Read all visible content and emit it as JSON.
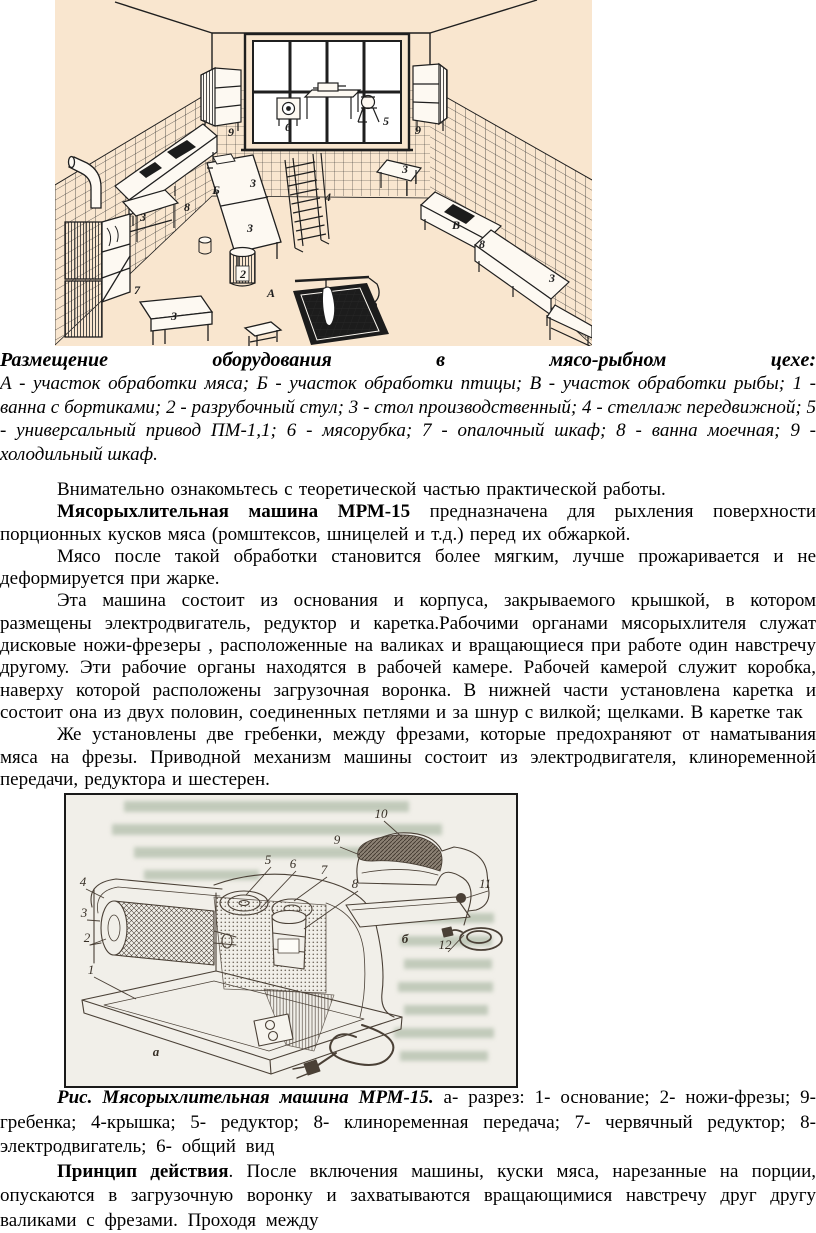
{
  "document": {
    "language": "ru",
    "page_background": "#ffffff",
    "text_color": "#000000"
  },
  "figure_workshop": {
    "background_color": "#f9e6cf",
    "line_color": "#1f1f1f",
    "labels": [
      {
        "t": "9",
        "x": 176,
        "y": 136
      },
      {
        "t": "Б",
        "x": 161,
        "y": 194
      },
      {
        "t": "8",
        "x": 132,
        "y": 211
      },
      {
        "t": "3",
        "x": 88,
        "y": 221
      },
      {
        "t": "7",
        "x": 82,
        "y": 294
      },
      {
        "t": "3",
        "x": 119,
        "y": 320
      },
      {
        "t": "6",
        "x": 233,
        "y": 131
      },
      {
        "t": "5",
        "x": 331,
        "y": 125
      },
      {
        "t": "9",
        "x": 363,
        "y": 134
      },
      {
        "t": "3",
        "x": 198,
        "y": 187
      },
      {
        "t": "3",
        "x": 195,
        "y": 232
      },
      {
        "t": "4",
        "x": 273,
        "y": 201
      },
      {
        "t": "2",
        "x": 188,
        "y": 278
      },
      {
        "t": "А",
        "x": 216,
        "y": 297
      },
      {
        "t": "3",
        "x": 350,
        "y": 173
      },
      {
        "t": "В",
        "x": 401,
        "y": 229
      },
      {
        "t": "8",
        "x": 427,
        "y": 248
      },
      {
        "t": "3",
        "x": 497,
        "y": 282
      }
    ]
  },
  "caption_workshop": {
    "title": "Размещение оборудования в мясо-рыбном цехе:",
    "legend": "А - участок обработки мяса; Б - участок обработки птицы; В - участок обработки рыбы; 1 - ванна с бортиками; 2 - разрубочный стул; 3 - стол производственный; 4 - стеллаж передвижной; 5 - универсальный привод ПМ-1,1; 6 - мясорубка; 7 - опалочный шкаф; 8 - ванна моечная; 9 - холодильный шкаф."
  },
  "body_text": {
    "p1": "Внимательно ознакомьтесь с теоретической частью практической работы.",
    "p2_bold": "Мясорыхлительная машина МРМ-15",
    "p2_rest": " предназначена для рыхления поверхности порционных кусков мяса (ромштексов, шницелей и т.д.) перед их обжаркой.",
    "p3": "Мясо после такой обработки становится более мягким, лучше прожаривается и не деформируется при жарке.",
    "p4": "Эта машина состоит из основания и корпуса, закрываемого крышкой, в котором размещены электродвигатель, редуктор и каретка.Рабочими органами мясорыхлителя служат дисковые ножи-фрезеры , расположенные на валиках и вращающиеся при работе один навстречу другому. Эти рабочие органы находятся в рабочей камере. Рабочей камерой служит коробка, наверху которой расположены загрузочная воронка. В нижней части установлена каретка и состоит она из двух половин, соединенных петлями и за шнур с вилкой; щелками. В каретке так",
    "p5": "Же установлены две гребенки, между фрезами, которые предохраняют от наматывания мяса на фрезы. Приводной механизм машины состоит из электродвигателя, клиноременной передачи, редуктора и шестерен."
  },
  "figure_machine": {
    "background_color": "#f1efe9",
    "line_color": "#4a4036",
    "border_color": "#1a1a1a",
    "letters": [
      {
        "n": "а",
        "x": 92,
        "y": 263
      },
      {
        "n": "б",
        "x": 341,
        "y": 150
      }
    ],
    "callouts": [
      {
        "n": "4",
        "x": 19,
        "y": 93,
        "tx": 40,
        "ty": 105
      },
      {
        "n": "3",
        "x": 20,
        "y": 124,
        "tx": 36,
        "ty": 128
      },
      {
        "n": "2",
        "x": 23,
        "y": 149,
        "tx": 42,
        "ty": 146
      },
      {
        "n": "1",
        "x": 27,
        "y": 181,
        "tx": 72,
        "ty": 206
      },
      {
        "n": "5",
        "x": 204,
        "y": 71,
        "tx": 182,
        "ty": 102
      },
      {
        "n": "6",
        "x": 229,
        "y": 75,
        "tx": 196,
        "ty": 116
      },
      {
        "n": "7",
        "x": 260,
        "y": 81,
        "tx": 230,
        "ty": 108
      },
      {
        "n": "8",
        "x": 291,
        "y": 95,
        "tx": 240,
        "ty": 136
      },
      {
        "n": "9",
        "x": 273,
        "y": 51,
        "tx": 296,
        "ty": 62
      },
      {
        "n": "10",
        "x": 317,
        "y": 25,
        "tx": 338,
        "ty": 44
      },
      {
        "n": "11",
        "x": 421,
        "y": 95,
        "tx": 402,
        "ty": 105
      },
      {
        "n": "12",
        "x": 381,
        "y": 156,
        "tx": 400,
        "ty": 142
      }
    ]
  },
  "caption_machine": {
    "bold": "Рис. Мясорыхлительная машина МРМ-15.",
    "rest": " а- разрез: 1- основание; 2- ножи-фрезы; 9- гребенка; 4-крышка; 5- редуктор; 8- клиноременная передача; 7- червячный редуктор; 8- электродвигатель; 6- общий вид"
  },
  "principle": {
    "bold": "Принцип действия",
    "rest": ". После включения машины, куски мяса, нарезанные на порции, опускаются в загрузочную воронку и захватываются вращающимися навстречу друг другу валиками с фрезами. Проходя между"
  }
}
